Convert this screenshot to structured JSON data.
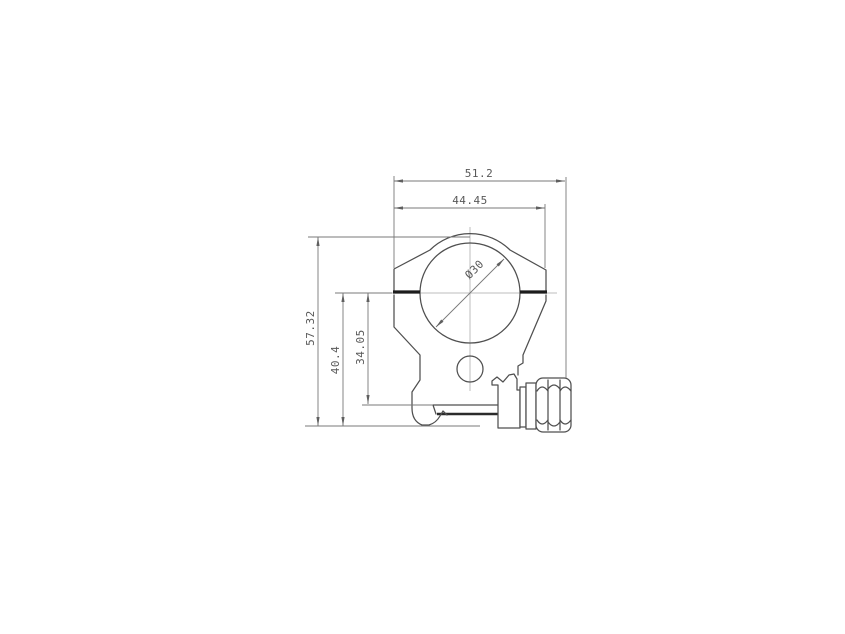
{
  "drawing": {
    "kind": "technical-drawing",
    "subject": "scope-ring-rail-mount-front-view",
    "dims": {
      "overall_width": "51.2",
      "ring_width": "44.45",
      "overall_height": "57.32",
      "base_to_split_height": "40.4",
      "rail_to_split_height": "34.05",
      "bore_diameter": "Ø30"
    },
    "colors": {
      "background": "#ffffff",
      "outline": "#4f4f4f",
      "dimension_line": "#787878",
      "split_line": "#1c1c1c",
      "label_text": "#585858"
    }
  }
}
